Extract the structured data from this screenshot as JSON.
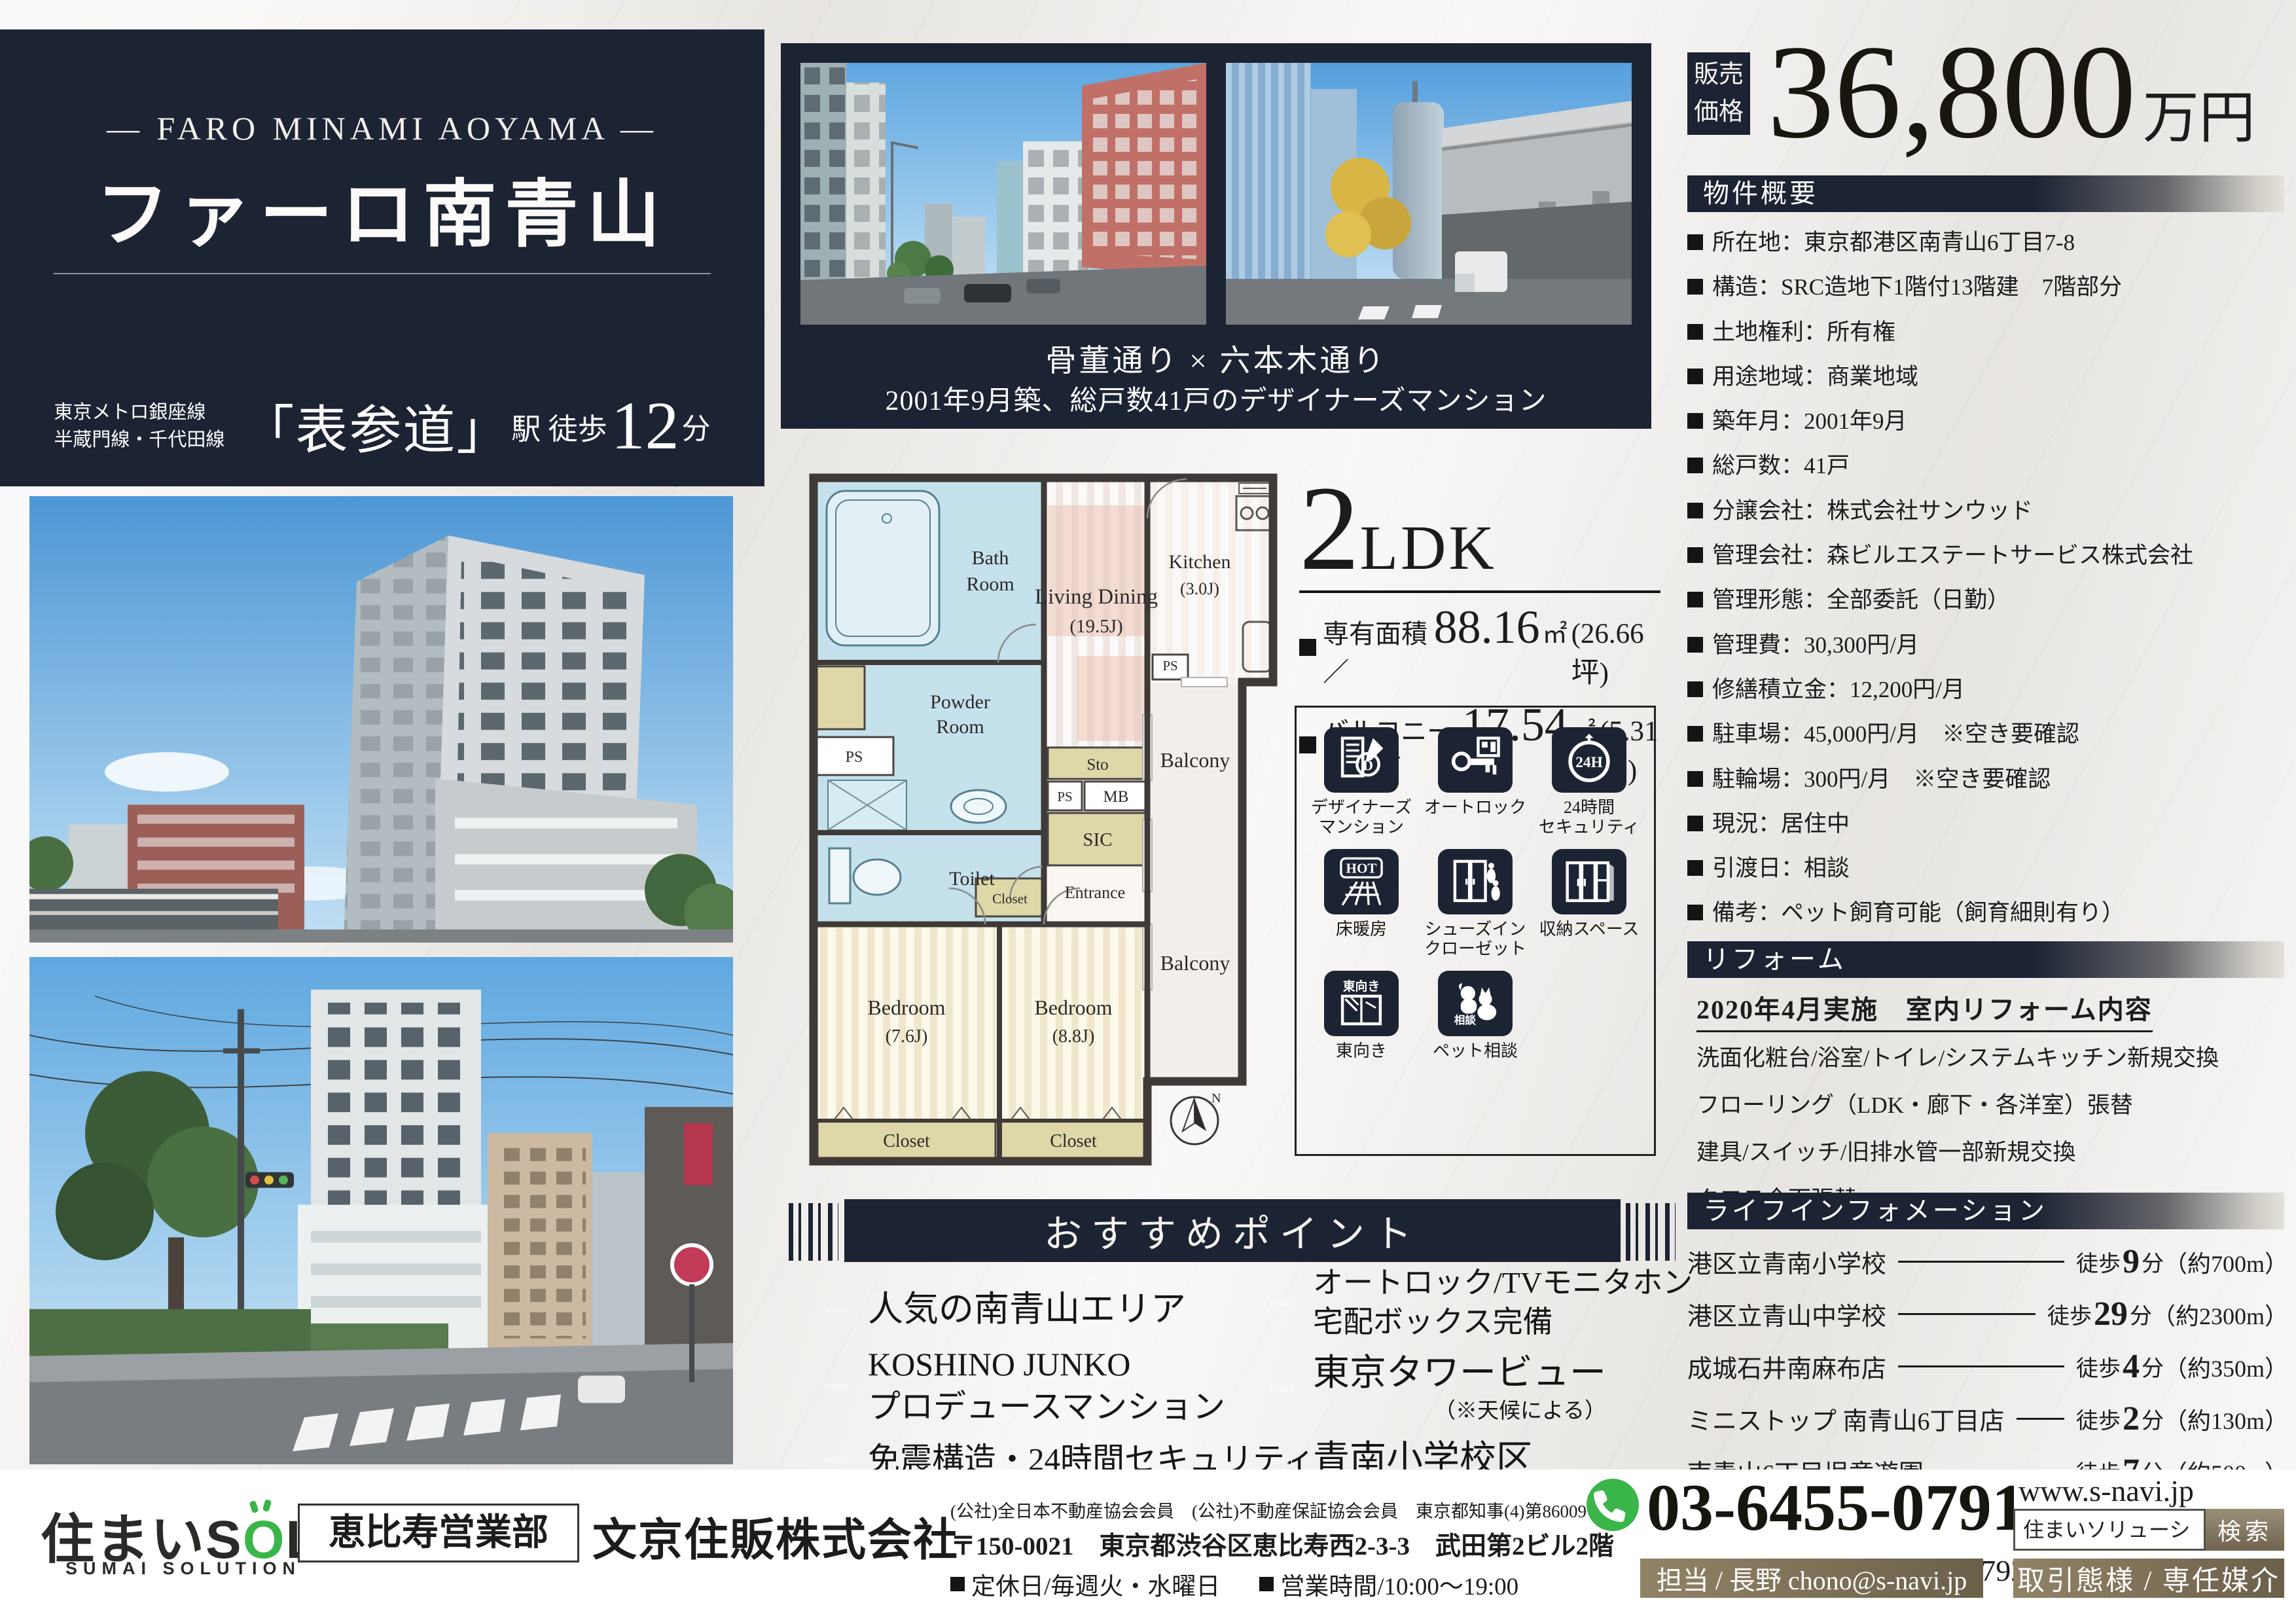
{
  "colors": {
    "navy": "#1c2433",
    "green": "#3ab54a",
    "taupe": "#7c715a",
    "room_blue": "#c5e1eb",
    "khaki": "#ded7a8",
    "pink": "#f5dcd3"
  },
  "hero": {
    "subtitle_en": "— FARO MINAMI AOYAMA —",
    "title": "ファーロ南青山",
    "station_line1": "東京メトロ銀座線",
    "station_line2": "半蔵門線・千代田線",
    "station_name": "「表参道」",
    "station_mid": "駅 徒歩",
    "station_min": "12",
    "station_unit": "分"
  },
  "top_photos": {
    "caption1": "骨董通り × 六本木通り",
    "caption2": "2001年9月築、総戸数41戸のデザイナーズマンション"
  },
  "price": {
    "label": "販売\n価格",
    "amount": "36,800",
    "unit": "万円"
  },
  "overview": {
    "title": "物件概要",
    "items": [
      "所在地：東京都港区南青山6丁目7-8",
      "構造：SRC造地下1階付13階建　7階部分",
      "土地権利：所有権",
      "用途地域：商業地域",
      "築年月：2001年9月",
      "総戸数：41戸",
      "分譲会社：株式会社サンウッド",
      "管理会社：森ビルエステートサービス株式会社",
      "管理形態：全部委託（日勤）",
      "管理費：30,300円/月",
      "修繕積立金：12,200円/月",
      "駐車場：45,000円/月　※空き要確認",
      "駐輪場：300円/月　※空き要確認",
      "現況：居住中",
      "引渡日：相談",
      "備考：ペット飼育可能（飼育細則有り）"
    ]
  },
  "reform": {
    "title": "リフォーム",
    "subtitle": "2020年4月実施　室内リフォーム内容",
    "lines": [
      "洗面化粧台/浴室/トイレ/システムキッチン新規交換",
      "フローリング（LDK・廊下・各洋室）張替",
      "建具/スイッチ/旧排水管一部新規交換",
      "クロス全面張替"
    ]
  },
  "life_info": {
    "title": "ライフインフォメーション",
    "walk_prefix": "徒歩",
    "walk_suffix": "分",
    "items": [
      {
        "name": "港区立青南小学校",
        "min": "9",
        "dist": "（約700m）"
      },
      {
        "name": "港区立青山中学校",
        "min": "29",
        "dist": "（約2300m）"
      },
      {
        "name": "成城石井南麻布店",
        "min": "4",
        "dist": "（約350m）"
      },
      {
        "name": "ミニストップ 南青山6丁目店",
        "min": "2",
        "dist": "（約130m）"
      },
      {
        "name": "南青山6丁目児童遊園",
        "min": "7",
        "dist": "（約500m）"
      }
    ]
  },
  "unit": {
    "type_num": "2",
    "type_txt": "LDK",
    "area1_label": "専有面積／",
    "area1_value": "88.16",
    "area1_unit": "㎡",
    "area1_tsubo": "(26.66坪)",
    "area2_label": "バルコニー面積／",
    "area2_value": "17.54",
    "area2_unit": "㎡",
    "area2_tsubo": "(5.31坪)"
  },
  "features": {
    "items": [
      {
        "icon": "designer-mansion-icon",
        "label": "デザイナーズ\nマンション",
        "glyph_text": "D"
      },
      {
        "icon": "autolock-icon",
        "label": "オートロック",
        "glyph_text": ""
      },
      {
        "icon": "security-24h-icon",
        "label": "24時間\nセキュリティ",
        "glyph_text": "24H"
      },
      {
        "icon": "floor-heating-icon",
        "label": "床暖房",
        "glyph_text": "HOT"
      },
      {
        "icon": "shoes-in-closet-icon",
        "label": "シューズイン\nクローゼット",
        "glyph_text": ""
      },
      {
        "icon": "storage-space-icon",
        "label": "収納スペース",
        "glyph_text": ""
      },
      {
        "icon": "east-facing-icon",
        "label": "東向き",
        "glyph_text": "東向き"
      },
      {
        "icon": "pet-consult-icon",
        "label": "ペット相談",
        "glyph_text": "相談"
      }
    ]
  },
  "points": {
    "title": "おすすめポイント",
    "badge": "POINT",
    "items": [
      {
        "text": "人気の南青山エリア",
        "note": ""
      },
      {
        "text": "KOSHINO JUNKO\nプロデュースマンション",
        "note": ""
      },
      {
        "text": "免震構造・24時間セキュリティ",
        "note": ""
      },
      {
        "text": "オートロック/TVモニタホン\n宅配ボックス完備",
        "note": ""
      },
      {
        "text": "東京タワービュー",
        "note": "（※天候による）"
      },
      {
        "text": "青南小学校区",
        "note": ""
      }
    ]
  },
  "floorplan": {
    "bath1": "Bath",
    "bath2": "Room",
    "powder1": "Powder",
    "powder2": "Room",
    "toilet": "Toilet",
    "ps": "PS",
    "sto": "Sto",
    "mb": "MB",
    "sic": "SIC",
    "closet": "Closet",
    "entrance": "Entrance",
    "ld1": "Living Dining",
    "ld2": "(19.5J)",
    "kitchen1": "Kitchen",
    "kitchen2": "(3.0J)",
    "balcony": "Balcony",
    "bed1": "Bedroom",
    "bed1s": "(7.6J)",
    "bed2": "Bedroom",
    "bed2s": "(8.8J)",
    "north": "N"
  },
  "footer": {
    "logo_prefix": "住まいS",
    "logo_o": "O",
    "logo_suffix": "L",
    "logo_sub": "SUMAI SOLUTION",
    "dept": "恵比寿営業部",
    "company": "文京住販株式会社",
    "memberships": "(公社)全日本不動産協会会員　(公社)不動産保証協会会員　東京都知事(4)第86009号",
    "address": "〒150-0021　東京都渋谷区恵比寿西2-3-3　武田第2ビル2階",
    "holiday": "定休日/毎週火・水曜日",
    "hours": "営業時間/10:00～19:00",
    "tel": "03-6455-0791",
    "fax": "FAX：03-6455-0792",
    "web": "www.s-navi.jp",
    "search_value": "住まいソリューション",
    "search_button": "検索",
    "contact": "担当 / 長野  chono@s-navi.jp",
    "deal": "取引態様 / 専任媒介"
  }
}
